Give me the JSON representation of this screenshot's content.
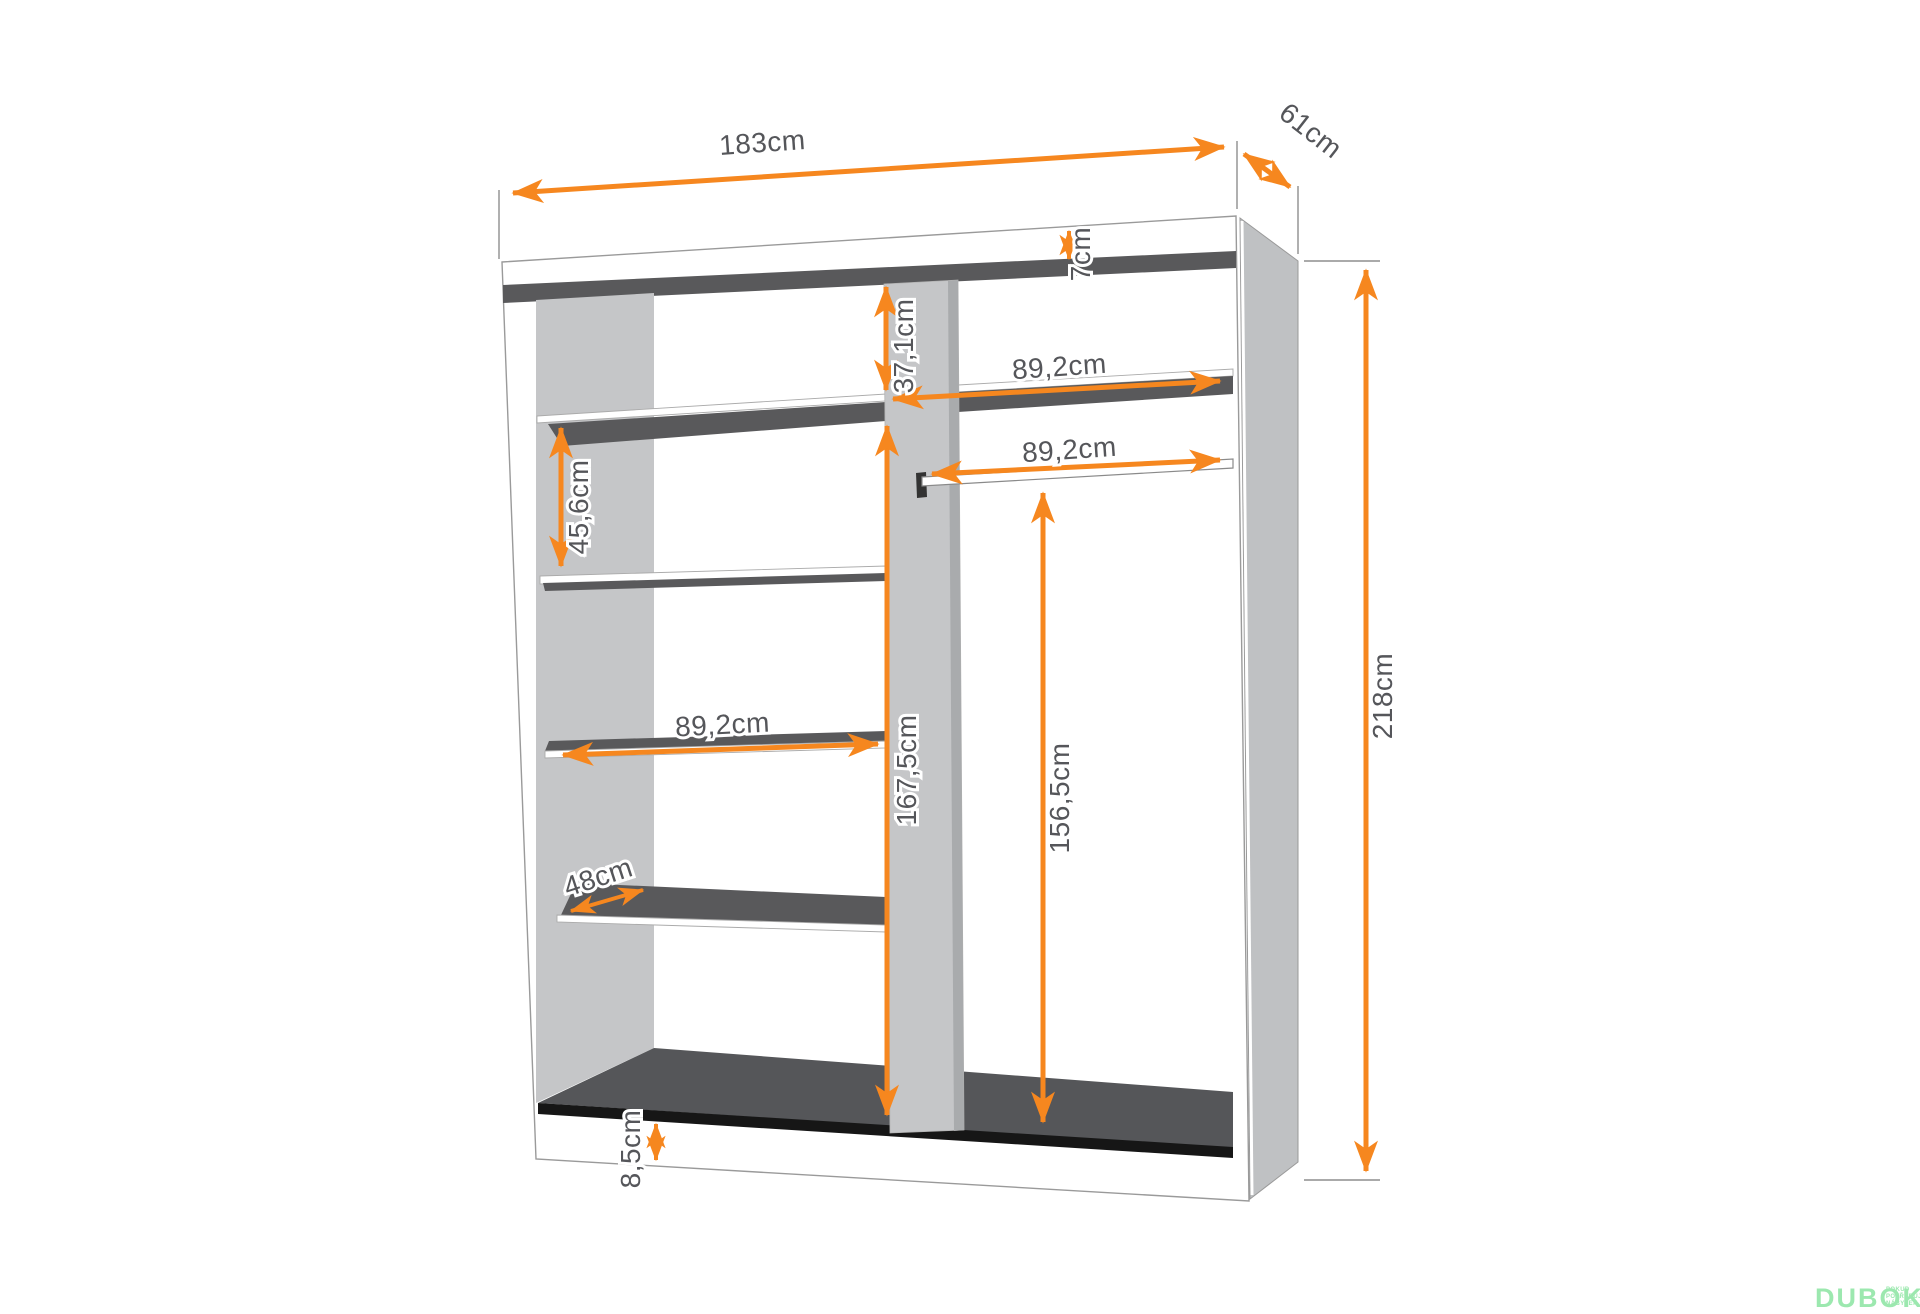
{
  "dimensions": {
    "width": {
      "label": "183cm"
    },
    "depth": {
      "label": "61cm"
    },
    "top_panel": {
      "label": "7cm"
    },
    "top_section": {
      "label": "37,1cm"
    },
    "shelf_gap": {
      "label": "45,6cm"
    },
    "inner_width_top": {
      "label": "89,2cm"
    },
    "rod_width": {
      "label": "89,2cm"
    },
    "inner_width_left": {
      "label": "89,2cm"
    },
    "shelf_depth": {
      "label": "48cm"
    },
    "divider_height": {
      "label": "167,5cm"
    },
    "rod_height": {
      "label": "156,5cm"
    },
    "total_height": {
      "label": "218cm"
    },
    "plinth_height": {
      "label": "8,5cm"
    }
  },
  "logo": {
    "brand": "DUBOK",
    "tagline_lines": [
      "POKUD",
      "POTŘEBUJETE",
      "NÁBYTEK"
    ]
  },
  "colors": {
    "arrow": "#F6871F",
    "panel_light": "#C5C6C8",
    "panel_dark": "#59595B",
    "floor": "#555659",
    "strip": "#161616",
    "line": "#9A9A9A",
    "label_text": "#55565A",
    "logo_green": "#9CE8AF"
  }
}
